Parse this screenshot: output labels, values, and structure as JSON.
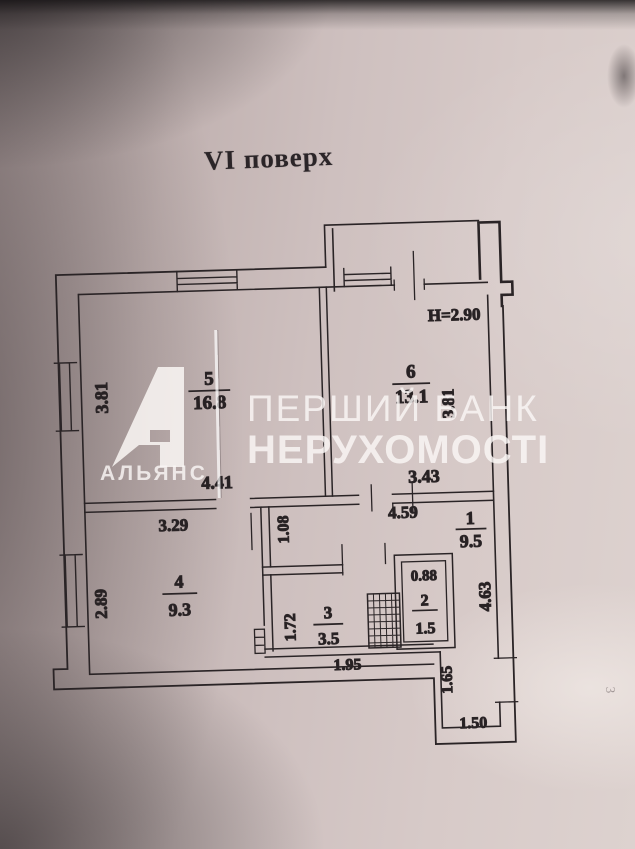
{
  "photo": {
    "title": "VI поверх",
    "page_mark": "3",
    "watermark": {
      "brand_line1": "ПЕРШИЙ БАНК",
      "brand_line2": "НЕРУХОМОСТІ",
      "logo_text": "АЛЬЯНС",
      "logo_letter": "А"
    }
  },
  "plan": {
    "height_note": "H=2.90",
    "rooms": [
      {
        "number": "5",
        "area": "16.8",
        "width": "4.41",
        "depth": "3.81"
      },
      {
        "number": "6",
        "area": "13.1",
        "width": "3.43",
        "depth": "3.81"
      },
      {
        "number": "4",
        "area": "9.3",
        "width": "3.29",
        "depth": "2.89"
      },
      {
        "number": "3",
        "area": "3.5",
        "width": "1.95",
        "depth": "1.72"
      },
      {
        "number": "2",
        "area": "1.5",
        "width": "0.88"
      },
      {
        "number": "1",
        "area": "9.5",
        "width": "4.59",
        "depth": "4.63"
      }
    ],
    "dims": {
      "passage": "1.08",
      "entry_depth": "1.65",
      "entry_width": "1.50"
    },
    "colors": {
      "ink": "#2a2426",
      "paper": "#d3c6c4",
      "watermark": "#f7f3f1"
    }
  }
}
